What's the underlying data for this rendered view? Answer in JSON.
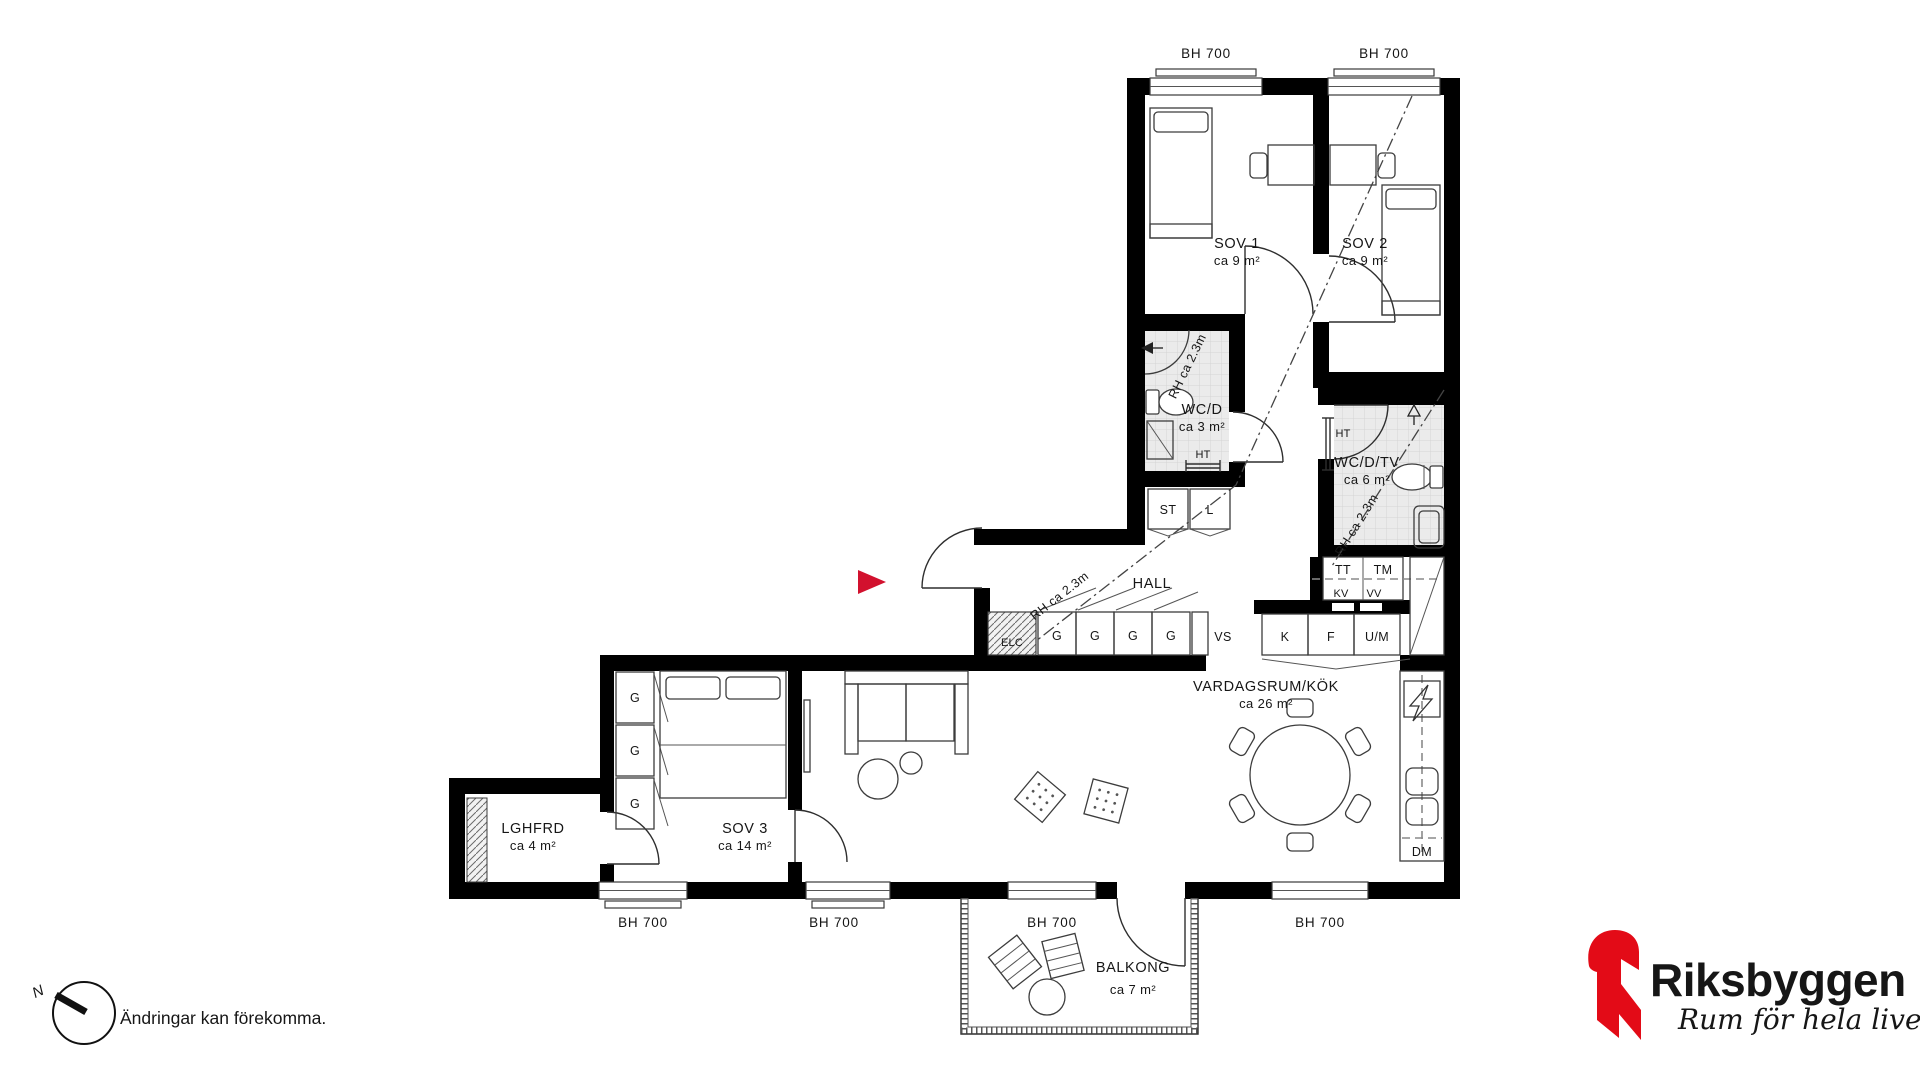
{
  "labels": {
    "rooms": {
      "sov1": {
        "name": "SOV 1",
        "area": "ca 9 m²"
      },
      "sov2": {
        "name": "SOV 2",
        "area": "ca 9 m²"
      },
      "sov3": {
        "name": "SOV 3",
        "area": "ca 14 m²"
      },
      "wcd": {
        "name": "WC/D",
        "area": "ca 3 m²"
      },
      "wcdtv": {
        "name": "WC/D/TV",
        "area": "ca 6 m²"
      },
      "hall": {
        "name": "HALL"
      },
      "vardagsrum": {
        "name": "VARDAGSRUM/KÖK",
        "area": "ca 26 m²"
      },
      "lghfrd": {
        "name": "LGHFRD",
        "area": "ca 4 m²"
      },
      "balkong": {
        "name": "BALKONG",
        "area": "ca 7 m²"
      }
    },
    "fixtures": {
      "g": "G",
      "st": "ST",
      "l": "L",
      "vs": "VS",
      "elc": "ELC",
      "k": "K",
      "f": "F",
      "um": "U/M",
      "tt": "TT",
      "tm": "TM",
      "kv": "KV",
      "vv": "VV",
      "ht": "HT",
      "dm": "DM"
    },
    "dimension_bh": "BH 700",
    "ceiling_height": "RH ca 2.3m",
    "north": "N"
  },
  "footer": {
    "disclaimer": "Ändringar kan förekomma."
  },
  "logo": {
    "brand": "Riksbyggen",
    "tagline": "Rum för hela livet",
    "brand_color": "#e30b17",
    "text_color": "#9c9b9b"
  },
  "colors": {
    "entry_marker": "#d2112e",
    "walls": "#000000",
    "tile_bg": "#ebebeb"
  }
}
